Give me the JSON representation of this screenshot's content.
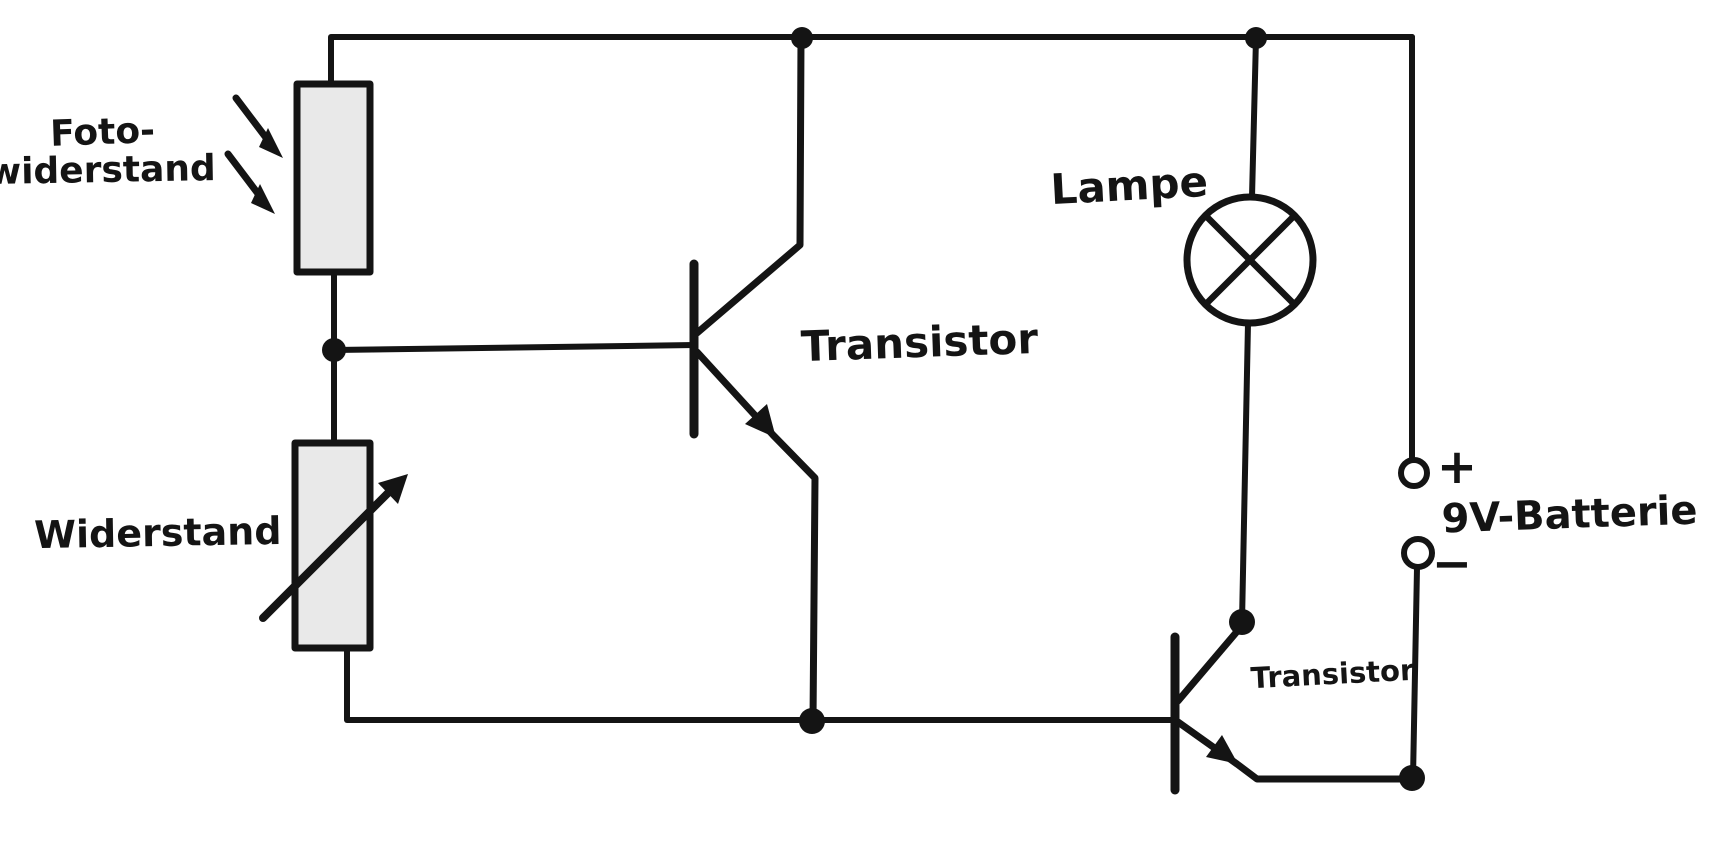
{
  "diagram": {
    "kind": "hand-drawn circuit schematic",
    "colors": {
      "background": "#ffffff",
      "ink": "#141414",
      "component_fill": "#e9e9e9"
    },
    "labels": {
      "photoresistor_line1": "Foto-",
      "photoresistor_line2": "widerstand",
      "resistor": "Widerstand",
      "transistor_left": "Transistor",
      "lamp": "Lampe",
      "transistor_right": "Transistor",
      "battery": "9V-Batterie",
      "battery_plus": "+",
      "battery_minus": "−"
    },
    "components": [
      {
        "symbol": "photoresistor-symbol",
        "label": "Foto-widerstand"
      },
      {
        "symbol": "variable-resistor-symbol",
        "label": "Widerstand"
      },
      {
        "symbol": "npn-transistor-symbol",
        "label": "Transistor"
      },
      {
        "symbol": "lamp-symbol",
        "label": "Lampe"
      },
      {
        "symbol": "npn-transistor-symbol",
        "label": "Transistor"
      },
      {
        "symbol": "battery-terminals-symbol",
        "label": "9V-Batterie"
      }
    ]
  }
}
